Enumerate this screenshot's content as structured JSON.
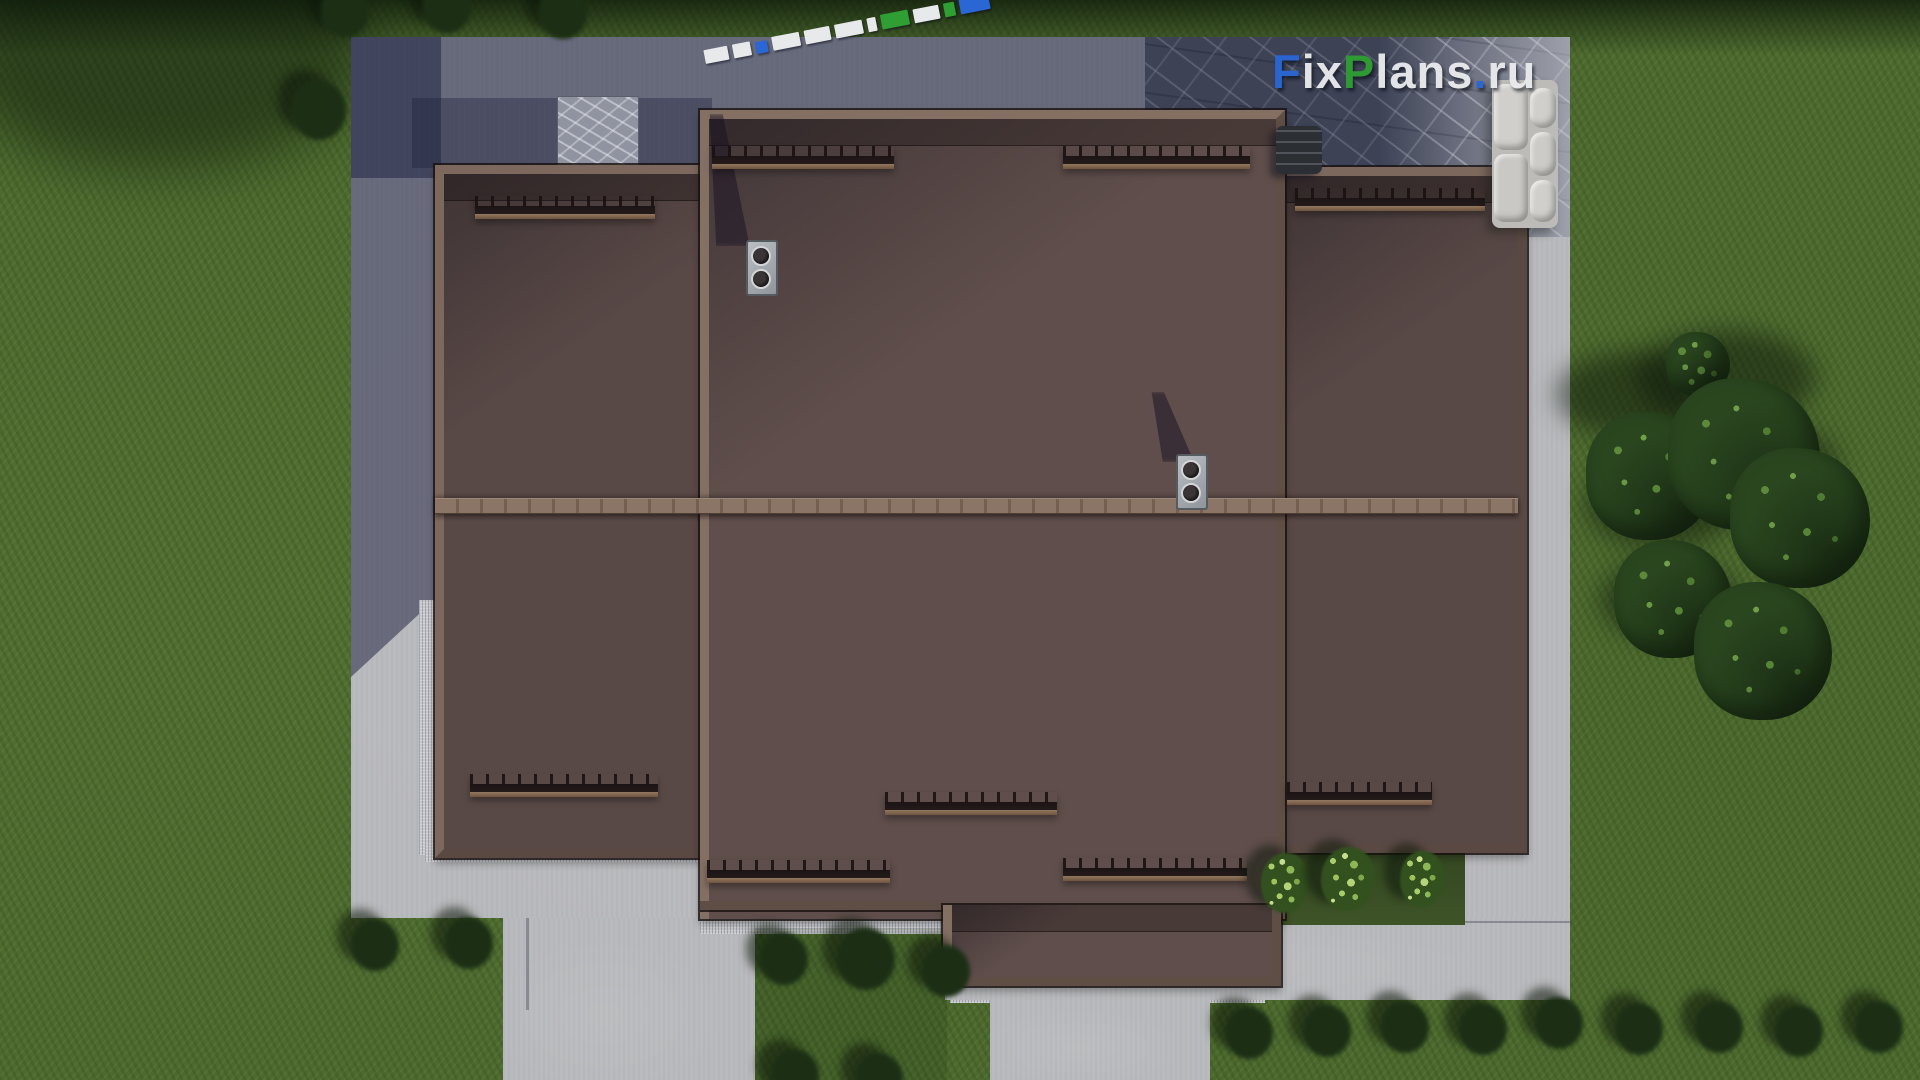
{
  "scene": {
    "label": "Aerial top-down 3D render of a house roof plan with landscaped yard",
    "watermark_text": "FixPlans.ru",
    "elements": [
      "brown tiled hip roof with left, center and right wings",
      "lower roof extension over terrace",
      "two metal double-flue roof vents with cast shadows",
      "nine dark snow-guard rails on roof planes",
      "paved driveway partly in building shadow",
      "stone patio with L-shaped garden sofa and dark coffee table",
      "3D letter-top marker lying on shadowed paving",
      "concrete garden paths and gravel drainage strips",
      "lawn with white flower bushes and light-green shrubs",
      "tree cluster on the right lawn"
    ]
  },
  "branding": {
    "site_name": "FixPlans.ru",
    "logo": {
      "f": "F",
      "ix": "ix",
      "p": "P",
      "lans": "lans",
      "dot": ".",
      "ru": "ru"
    }
  },
  "palette": {
    "grass": "#4d6a2e",
    "grass_dark": "#27391c",
    "pavement": "#b9babd",
    "pavement_shadow": "rgba(30,34,66,0.52)",
    "stone_dark": "#565b6e",
    "stone_light": "#b4b5ba",
    "roof_tile": "#5f4e4b",
    "roof_fascia": "#846f63",
    "ridge": "#8b7567",
    "guard": "#1b1415",
    "rail": "#8a6f58",
    "chimney": "#a9aeb4",
    "flower": "#f4f4ef",
    "bush": "#8fb757",
    "tree": "#2a461f",
    "sofa": "#c7c6c2",
    "logo_blue": "#2a66d4",
    "logo_green": "#2f9e33",
    "logo_white": "#e9eaec"
  }
}
